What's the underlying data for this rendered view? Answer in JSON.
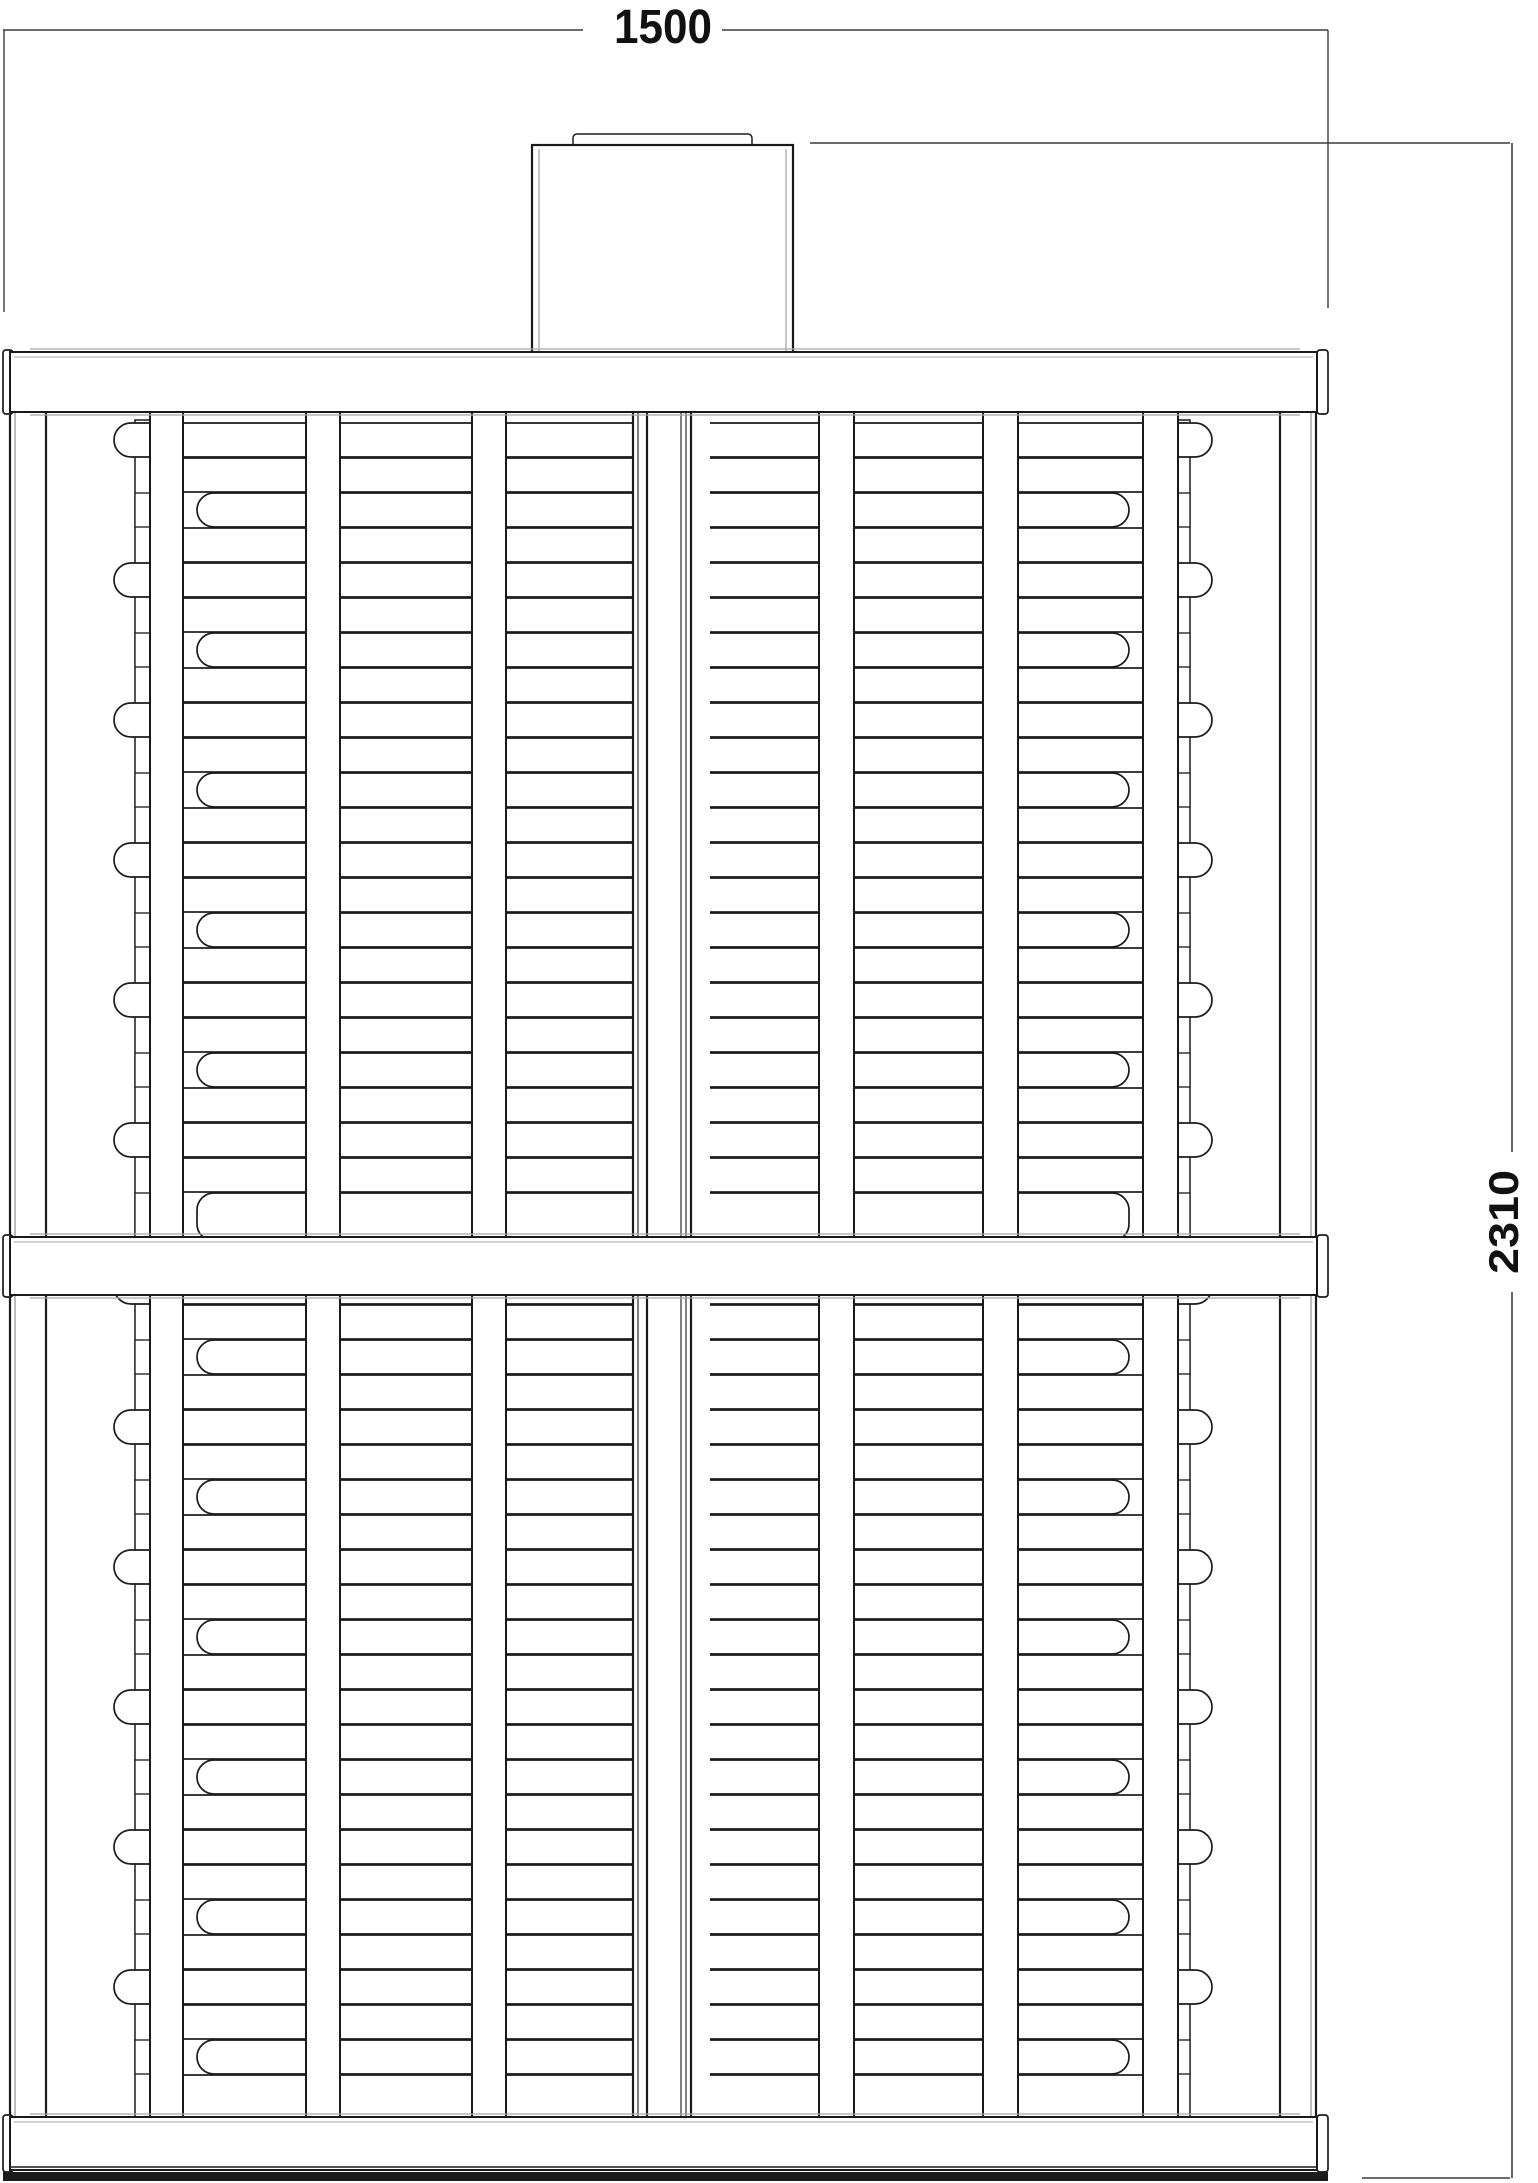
{
  "drawing": {
    "title": "rack-elevation-technical-drawing",
    "dimensions": {
      "width_label": "1500",
      "height_label": "2310"
    },
    "colors": {
      "background": "#ffffff",
      "line": "#1a1a1a",
      "line_soft": "#a8a8a8",
      "dim_line": "#3c3c3c",
      "band": "#1c1c1c"
    },
    "structure": {
      "canvas": {
        "width": 1538,
        "height": 2183
      },
      "frame": {
        "x1": 3,
        "x2": 1328,
        "inner_x1": 10,
        "inner_x2": 1317
      },
      "beams": [
        {
          "name": "top-beam",
          "y1": 352,
          "y2": 412,
          "bottom": false
        },
        {
          "name": "middle-beam",
          "y1": 1237,
          "y2": 1295,
          "bottom": false
        },
        {
          "name": "bottom-beam",
          "y1": 2117,
          "y2": 2170,
          "bottom": true
        }
      ],
      "box": {
        "x1": 532,
        "x2": 793,
        "y1": 145,
        "y2": 354,
        "lip": {
          "x1": 573,
          "x2": 752,
          "y1": 134,
          "h": 18
        }
      },
      "tiers": [
        {
          "y1": 412,
          "y2": 1237,
          "row_start": 423
        },
        {
          "y1": 1295,
          "y2": 2117,
          "row_start": 1270
        }
      ],
      "row": {
        "h": 34,
        "pitch": 35,
        "cycle": [
          "cap",
          "full",
          "short",
          "full"
        ]
      },
      "posts": [
        {
          "x1": 10,
          "x2": 46,
          "inner": 15
        },
        {
          "x1": 1280,
          "x2": 1316,
          "inner": 1311
        }
      ],
      "rods": [
        {
          "x1": 135,
          "x2": 150
        },
        {
          "x1": 1175,
          "x2": 1190
        }
      ],
      "slats": [
        [
          150,
          183
        ],
        [
          306,
          340
        ],
        [
          472,
          506
        ],
        [
          819,
          854
        ],
        [
          983,
          1018
        ],
        [
          1143,
          1178
        ]
      ],
      "mast": {
        "x1": 633,
        "x2": 710,
        "lines": [
          [
            633,
            2.2
          ],
          [
            638,
            1.1
          ],
          [
            647,
            2.2
          ],
          [
            681,
            1.1
          ],
          [
            686,
            1.1
          ],
          [
            691,
            2.2
          ]
        ]
      },
      "tubes": {
        "cap_x1": 114,
        "cap_x2": 1212,
        "full_x1": 160,
        "full_x2": 1160,
        "short_x1": 197,
        "short_x2": 1129,
        "r": 17
      },
      "dims": {
        "width": {
          "y": 30,
          "x1": 3,
          "x2": 1328,
          "gap": [
            583,
            722
          ],
          "text": {
            "x": 663,
            "y": 43,
            "size": 48,
            "len": 98
          },
          "ext": [
            [
              4,
              30,
              4,
              312
            ],
            [
              1328,
              30,
              1328,
              308
            ]
          ]
        },
        "height": {
          "x": 1512,
          "y1": 143,
          "y2": 2178,
          "gap": [
            1152,
            1292
          ],
          "text": {
            "x": 1518,
            "y": 1222,
            "size": 42,
            "len": 104
          },
          "ext": [
            [
              810,
              143,
              1510,
              143
            ],
            [
              1362,
              2178,
              1510,
              2178
            ]
          ]
        }
      }
    }
  }
}
